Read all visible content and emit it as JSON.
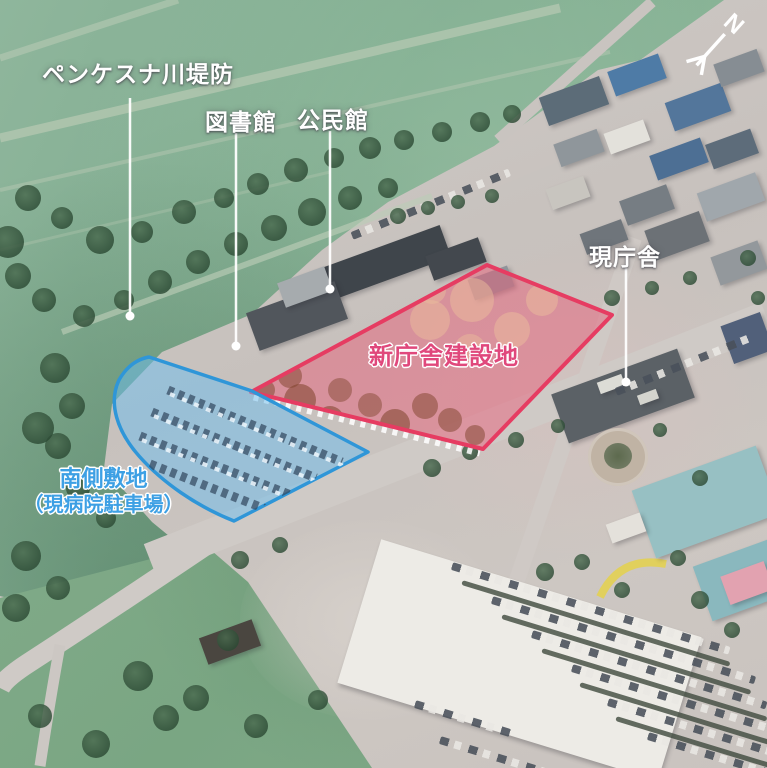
{
  "annotations": {
    "embankment": {
      "label": "ペンケスナ川堤防"
    },
    "library": {
      "label": "図書館"
    },
    "community_hall": {
      "label": "公民館"
    },
    "current_office": {
      "label": "現庁舎"
    },
    "new_office_site": {
      "label": "新庁舎建設地"
    },
    "south_site": {
      "line1": "南側敷地",
      "line2": "（現病院駐車場）"
    }
  },
  "compass": {
    "label": "N"
  },
  "colors": {
    "new_site_border": "#e63c62",
    "new_site_fill": "#ee7a93",
    "new_site_label": "#e0487c",
    "south_site_border": "#2f96d8",
    "south_site_fill": "#79c2ec",
    "south_site_label": "#3da0e4",
    "leader_line": "#ffffff"
  }
}
